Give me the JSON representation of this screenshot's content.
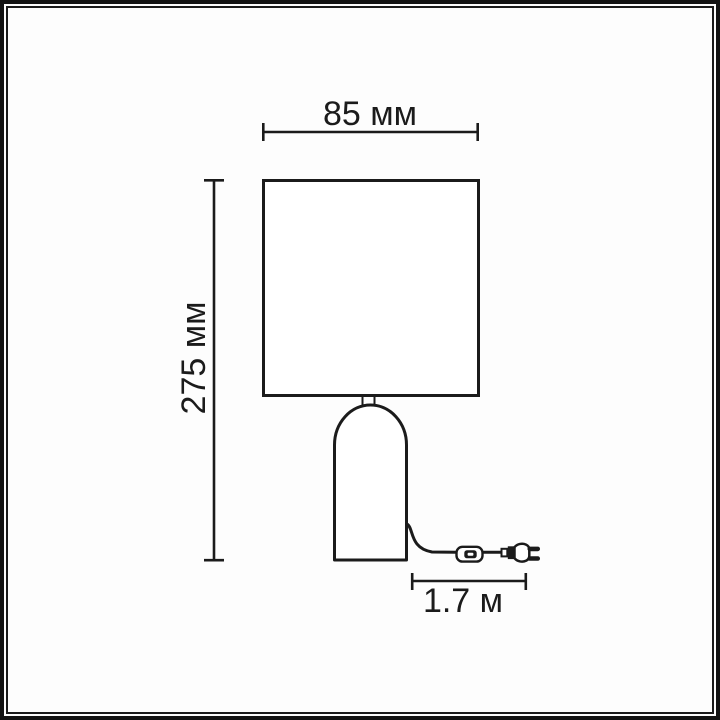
{
  "diagram": {
    "type": "product-dimension-drawing",
    "subject": "table-lamp",
    "labels": {
      "width": "85 мм",
      "height": "275 мм",
      "cord_length": "1.7 м"
    },
    "dimensions": {
      "width_value": "85",
      "width_unit": "мм",
      "height_value": "275",
      "height_unit": "мм",
      "cord_value": "1.7",
      "cord_unit": "м"
    },
    "colors": {
      "line": "#1b1b1b",
      "background": "#ffffff",
      "frame": "#131313"
    }
  }
}
